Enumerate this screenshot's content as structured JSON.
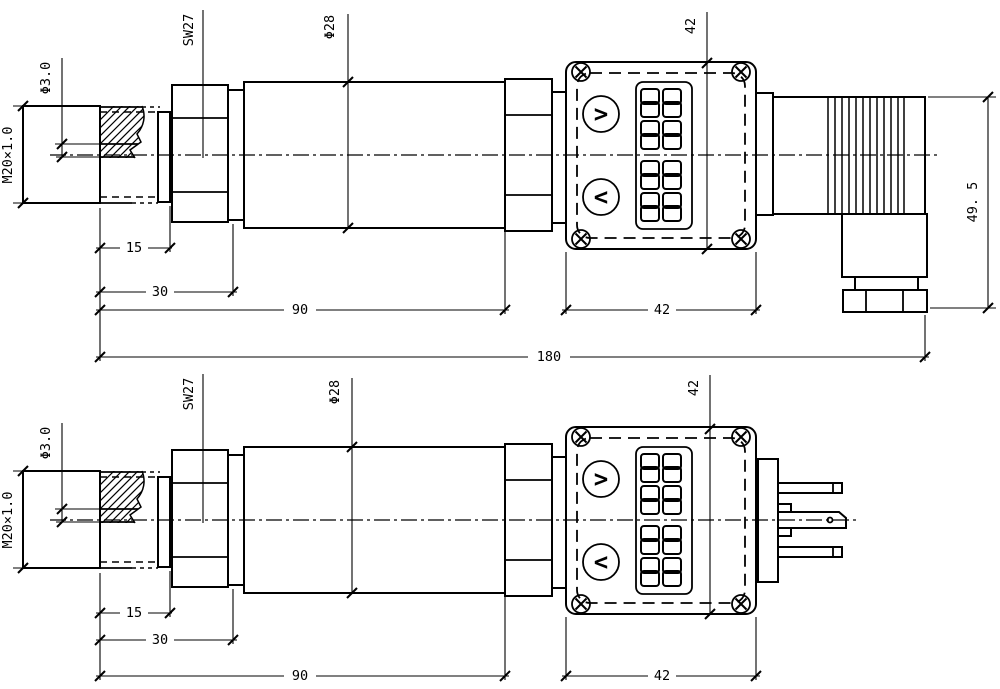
{
  "labels": {
    "bore_diameter": "Φ3.0",
    "process_thread": "M20×1.0",
    "wrench_size": "SW27",
    "body_diameter": "Φ28",
    "display_height": "42",
    "connector_height": "49. 5"
  },
  "dimensions": {
    "d15": "15",
    "d30": "30",
    "d90": "90",
    "d180": "180",
    "d42": "42"
  },
  "display": {
    "up_button_glyph": ">",
    "down_button_glyph": "<"
  }
}
